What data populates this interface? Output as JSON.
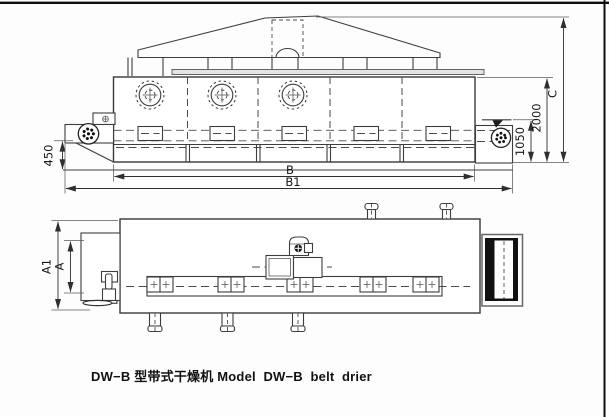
{
  "drawing": {
    "caption": "DW−B 型带式干燥机 Model  DW−B  belt  drier",
    "dims": {
      "d450": "450",
      "B": "B",
      "B1": "B1",
      "d1050": "1050",
      "d2000": "2000",
      "C": "C",
      "A": "A",
      "A1": "A1"
    },
    "colors": {
      "line": "#3d3d3d",
      "black_fill": "#111111",
      "top_plate": "#e4e4e4",
      "background": "#fdfdfd"
    }
  }
}
